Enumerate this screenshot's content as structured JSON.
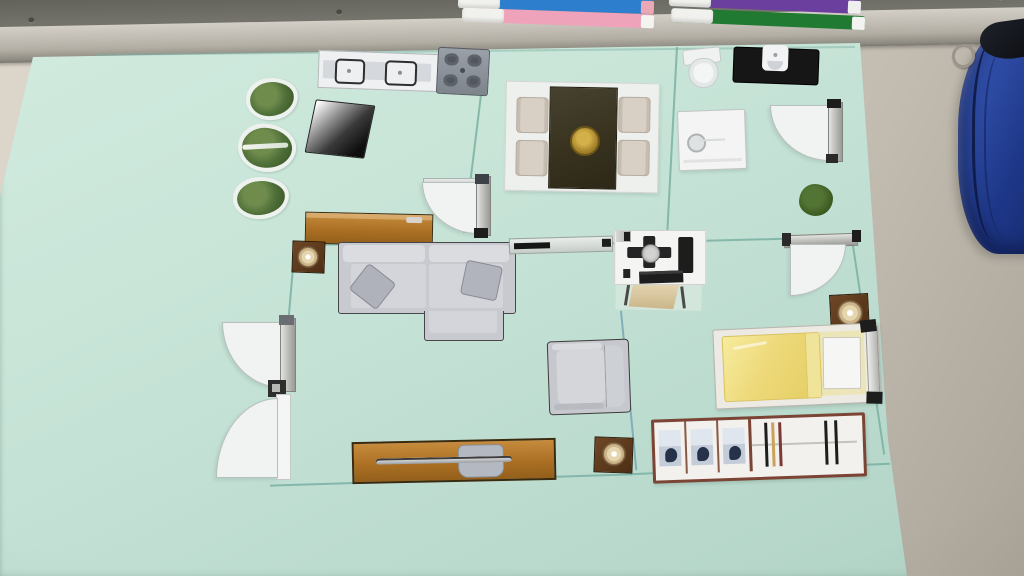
{
  "scene": {
    "description": "Photograph of a handmade apartment floor plan: paper furniture cutouts arranged on a mint-green poster board leaning on a whiteboard marker tray, with whiteboard markers above and a blue zippered pouch at the right edge.",
    "board": "mint green poster board with thin hand-drawn teal wall lines",
    "camera": "slightly tilted snapshot, soft indoor lighting"
  },
  "colors": {
    "board_mint": "#c8e5d8",
    "wall_teal": "#79b0a2",
    "desk_beige": "#d4cec2",
    "rail_silver": "#b2aea4",
    "frame_dark": "#6f6e66",
    "marker_blue": "#2e7ece",
    "marker_pink": "#efa3ba",
    "marker_purple": "#6b3f9d",
    "marker_green": "#217a31",
    "wood": "#ab7024",
    "table_dark": "#3c3626",
    "gold_plate": "#b5933c",
    "sofa_gray": "#c8cad0",
    "bed_yellow": "#ecd979",
    "plant_green": "#50703a",
    "bag_blue": "#2b49a0",
    "appliance_black": "#1a1a1a",
    "door_white": "#f1f3f2"
  },
  "whiteboard_tray": {
    "markers": [
      {
        "id": "marker-blue",
        "label": "blue whiteboard marker"
      },
      {
        "id": "marker-pink",
        "label": "pink whiteboard marker"
      },
      {
        "id": "marker-purple",
        "label": "purple whiteboard marker"
      },
      {
        "id": "marker-green",
        "label": "green whiteboard marker"
      }
    ]
  },
  "floor_plan": {
    "rooms": [
      "kitchen",
      "dining area",
      "bathroom",
      "living room",
      "study",
      "bedroom",
      "garden strip with plants"
    ],
    "furniture": [
      {
        "id": "sink-unit",
        "label": "Kitchen counter with double sink"
      },
      {
        "id": "stove",
        "label": "Four-burner stove top"
      },
      {
        "id": "wall-tv",
        "label": "Flat-screen TV cutout"
      },
      {
        "id": "plant-1",
        "label": "Potted plant"
      },
      {
        "id": "plant-2",
        "label": "Potted plant"
      },
      {
        "id": "plant-3",
        "label": "Potted plant"
      },
      {
        "id": "dining-set",
        "label": "Dark dining table with four beige chairs and gold platter"
      },
      {
        "id": "toilet",
        "label": "Toilet"
      },
      {
        "id": "washing-machine",
        "label": "Washing machine"
      },
      {
        "id": "shower",
        "label": "Shower base with knob"
      },
      {
        "id": "bathroom-door",
        "label": "Bathroom swing door"
      },
      {
        "id": "garden-bush",
        "label": "Small green bush"
      },
      {
        "id": "kitchen-door",
        "label": "Kitchen swing door"
      },
      {
        "id": "sideboard",
        "label": "Wooden sideboard shelf"
      },
      {
        "id": "side-table-1",
        "label": "Dark side table with round lamp"
      },
      {
        "id": "sofa",
        "label": "L-shaped gray sectional sofa with two pillows"
      },
      {
        "id": "window-slider",
        "label": "Silver wall window / sliding panel"
      },
      {
        "id": "desk",
        "label": "Computer desk with monitor, keyboard and beige chair"
      },
      {
        "id": "hinge-mark",
        "label": "Door hinge fitting on wall"
      },
      {
        "id": "study-door",
        "label": "Study swing door"
      },
      {
        "id": "nightstand",
        "label": "Nightstand with round lamp"
      },
      {
        "id": "bed",
        "label": "Single bed with yellow duvet, white pillow and silver headboard"
      },
      {
        "id": "armchair",
        "label": "Gray armchair"
      },
      {
        "id": "tv-console",
        "label": "Wooden TV console with slim TV panel"
      },
      {
        "id": "side-table-2",
        "label": "Dark side table with round lamp"
      },
      {
        "id": "wardrobe",
        "label": "Wardrobe: three shelves of folded clothes and hanging rail"
      },
      {
        "id": "living-door",
        "label": "Living room swing door"
      },
      {
        "id": "entry-door",
        "label": "Entry swing door"
      },
      {
        "id": "door-hinge",
        "label": "Hinge block between doors"
      }
    ]
  },
  "objects": {
    "bag": {
      "label": "Blue zippered pouch with metal clip"
    },
    "tray": {
      "label": "Whiteboard pen tray"
    }
  }
}
